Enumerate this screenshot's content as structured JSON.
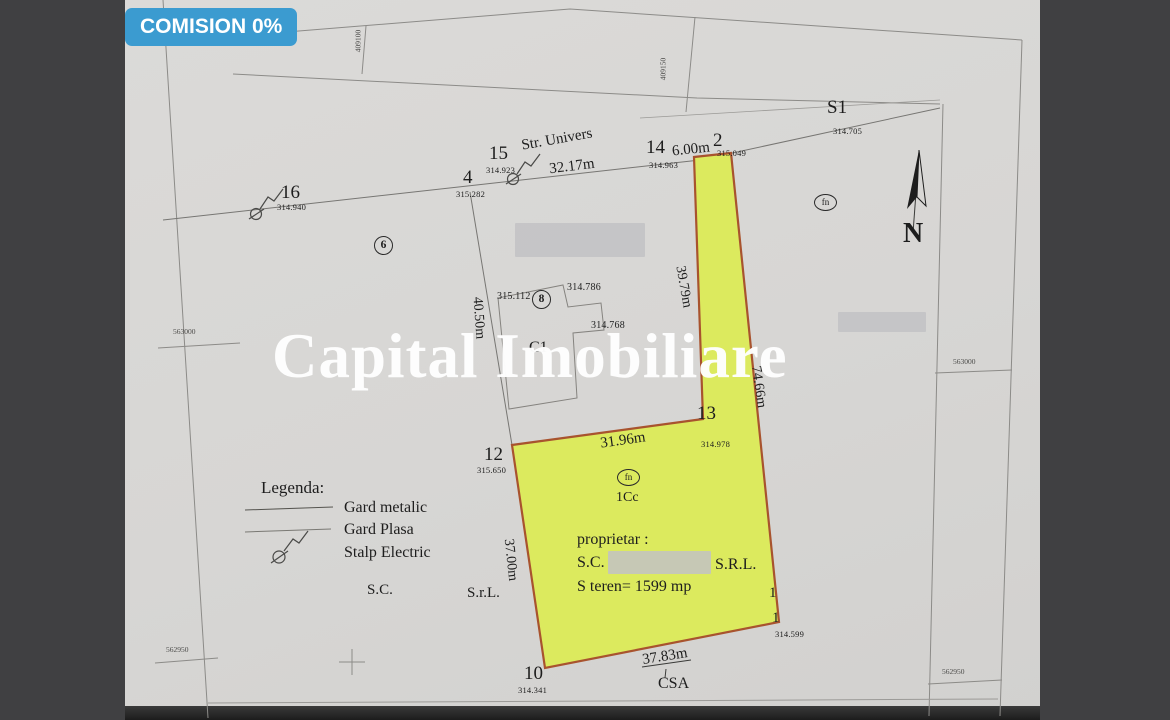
{
  "badge": {
    "label": "COMISION 0%"
  },
  "watermark": "Capital Imobiliare",
  "compass": {
    "label": "N"
  },
  "street": {
    "name": "Str. Univers"
  },
  "grid": {
    "top_left": "409100",
    "top_right": "409150",
    "left_top": "563000",
    "left_bottom": "562950",
    "right_top": "563000",
    "right_bottom": "562950"
  },
  "points": {
    "p16": {
      "id": "16",
      "elev": "314.940"
    },
    "p4": {
      "id": "4",
      "elev": "315.282"
    },
    "p15": {
      "id": "15",
      "elev": "314.923"
    },
    "p14": {
      "id": "14",
      "elev": "314.963"
    },
    "p2": {
      "id": "2",
      "elev": "315.049"
    },
    "ps1": {
      "id": "S1",
      "elev": "314.705"
    },
    "p12": {
      "id": "12",
      "elev": "315.650"
    },
    "p13": {
      "id": "13",
      "elev": "314.978"
    },
    "p10": {
      "id": "10",
      "elev": "314.341"
    },
    "p1a": {
      "id": "1"
    },
    "p1": {
      "id": "1",
      "elev": "314.599"
    },
    "e_315112": "315.112",
    "e_314786": "314.786",
    "e_314768": "314.768"
  },
  "circled": {
    "c6": "6",
    "c8": "8",
    "fn_top": "fn",
    "fn_parcel": "fn"
  },
  "labels": {
    "c1": "C1",
    "cc": "1Cc",
    "csa": "CSA"
  },
  "measurements": {
    "m_3217": "32.17m",
    "m_600": "6.00m",
    "m_3979": "39.79m",
    "m_7466": "74.66m",
    "m_3196": "31.96m",
    "m_3700": "37.00m",
    "m_3783": "37.83m",
    "m_4050": "40.50m"
  },
  "parcel_info": {
    "owner_label": "proprietar :",
    "company_prefix": "S.C.",
    "company_suffix": "S.R.L.",
    "area": "S teren= 1599 mp"
  },
  "legend": {
    "title": "Legenda:",
    "items": [
      "Gard metalic",
      "Gard Plasa",
      "Stalp Electric"
    ],
    "sc": "S.C.",
    "srl": "S.r.L."
  },
  "colors": {
    "badge_bg": "#3b9bd0",
    "parcel_fill": "#dcea5e",
    "parcel_border": "#a8532e",
    "line_gray": "#8c8b88"
  }
}
